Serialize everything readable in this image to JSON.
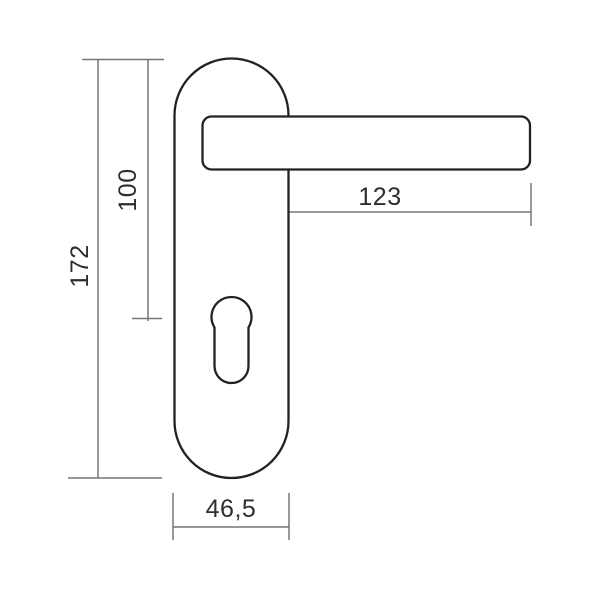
{
  "drawing": {
    "type": "technical-dimension-drawing",
    "subject": "door-handle-lever-on-long-backplate-with-euro-keyhole",
    "colors": {
      "outline": "#222222",
      "dimension": "#757575",
      "text": "#2e2e2e",
      "background": "#ffffff",
      "part_fill": "#ffffff"
    },
    "dimensions": {
      "plate_height": "172",
      "handle_axis_height": "100",
      "lever_length": "123",
      "plate_width": "46,5"
    }
  }
}
